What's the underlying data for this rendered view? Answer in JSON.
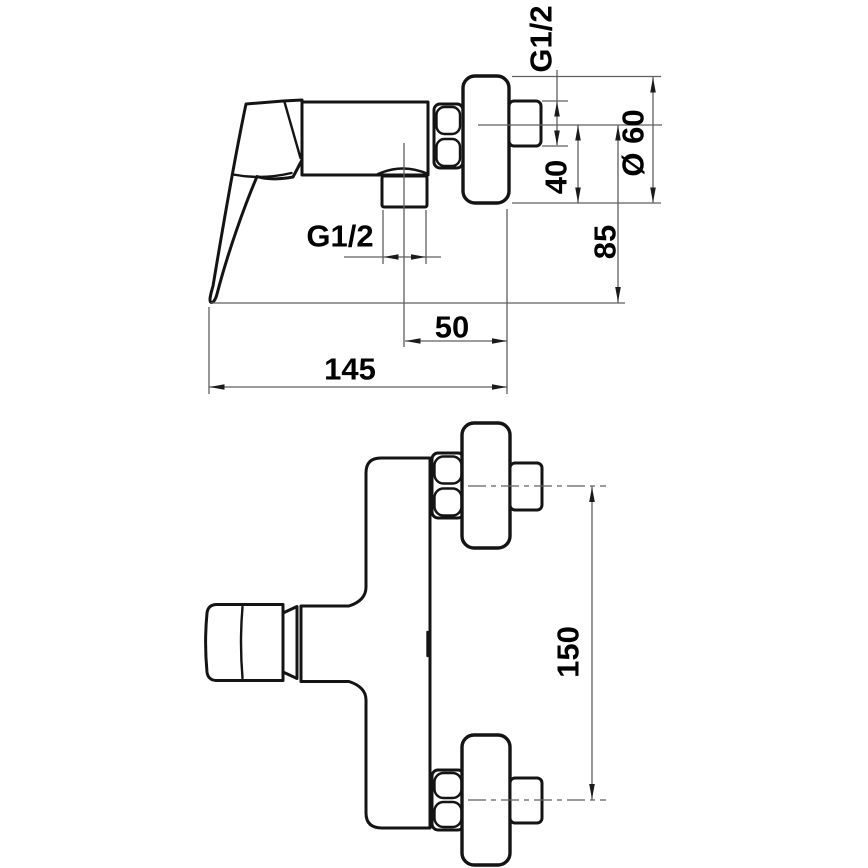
{
  "drawing": {
    "kind": "technical-dimension-drawing",
    "background_color": "#ffffff",
    "outline_color": "#141414",
    "dimension_line_color": "#5f5f5f",
    "text_color": "#000000",
    "views": {
      "side": {
        "dimensions": {
          "wall_thread": {
            "label": "G1/2"
          },
          "escutcheon_diameter": {
            "label": "Ø 60",
            "value": 60
          },
          "axis_to_body_bottom": {
            "label": "40",
            "value": 40
          },
          "axis_to_handle_bottom": {
            "label": "85",
            "value": 85
          },
          "outlet_thread": {
            "label": "G1/2"
          },
          "outlet_axis_to_wall": {
            "label": "50",
            "value": 50
          },
          "overall_depth": {
            "label": "145",
            "value": 145
          }
        }
      },
      "front": {
        "dimensions": {
          "connection_centres": {
            "label": "150",
            "value": 150
          }
        }
      }
    }
  }
}
